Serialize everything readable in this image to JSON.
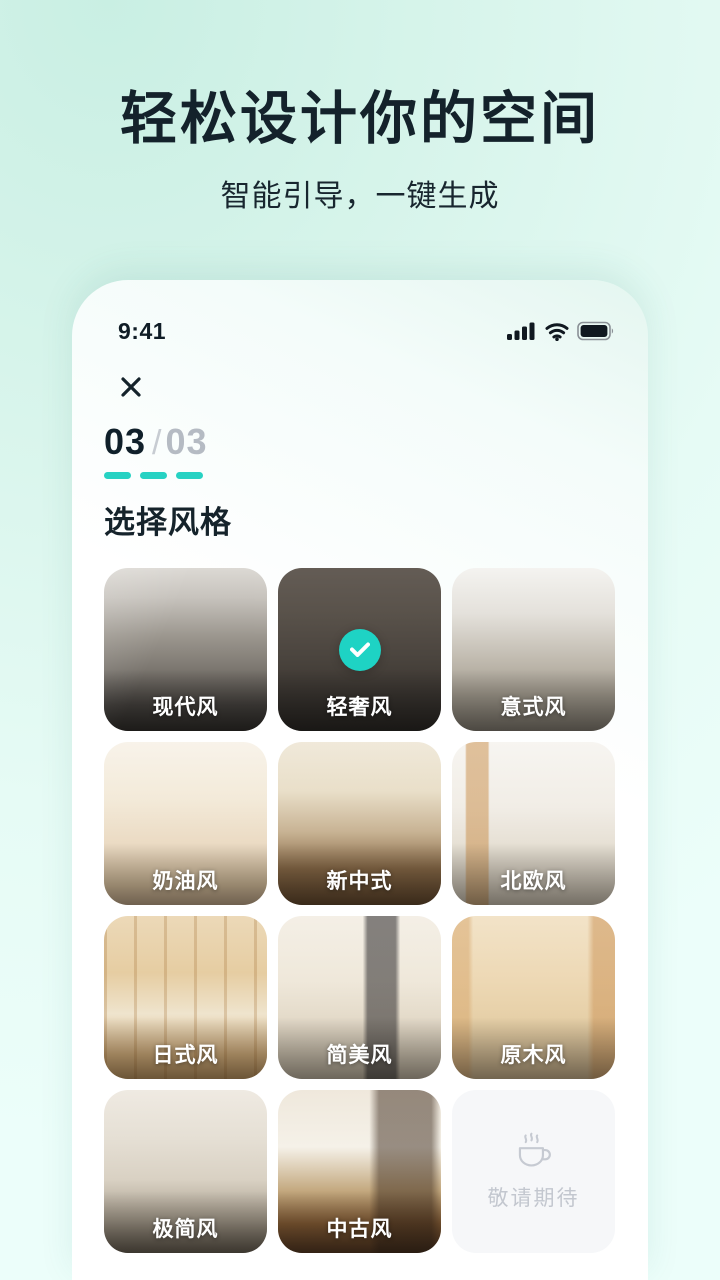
{
  "hero": {
    "title": "轻松设计你的空间",
    "subtitle": "智能引导，一键生成"
  },
  "status_bar": {
    "time": "9:41",
    "icons": [
      "cellular-signal-icon",
      "wifi-icon",
      "battery-icon"
    ]
  },
  "sheet": {
    "close_icon": "close-icon",
    "progress": {
      "current": "03",
      "divider": "/",
      "total": "03",
      "steps_done": 3,
      "steps_total": 3
    },
    "section_title": "选择风格",
    "styles": [
      {
        "label": "现代风",
        "selected": false
      },
      {
        "label": "轻奢风",
        "selected": true
      },
      {
        "label": "意式风",
        "selected": false
      },
      {
        "label": "奶油风",
        "selected": false
      },
      {
        "label": "新中式",
        "selected": false
      },
      {
        "label": "北欧风",
        "selected": false
      },
      {
        "label": "日式风",
        "selected": false
      },
      {
        "label": "简美风",
        "selected": false
      },
      {
        "label": "原木风",
        "selected": false
      },
      {
        "label": "极简风",
        "selected": false
      },
      {
        "label": "中古风",
        "selected": false
      }
    ],
    "coming_soon": {
      "label": "敬请期待",
      "icon": "coffee-cup-icon"
    }
  },
  "colors": {
    "accent_teal": "#27d2c3",
    "check_circle": "#1ed3c4",
    "heading_dark": "#14222b",
    "muted_gray": "#b5bbc3",
    "page_gradient_start": "#c9efe3",
    "page_gradient_end": "#ecfefa",
    "sheet_background": "#ffffff",
    "coming_soon_bg": "#f6f7f9"
  }
}
